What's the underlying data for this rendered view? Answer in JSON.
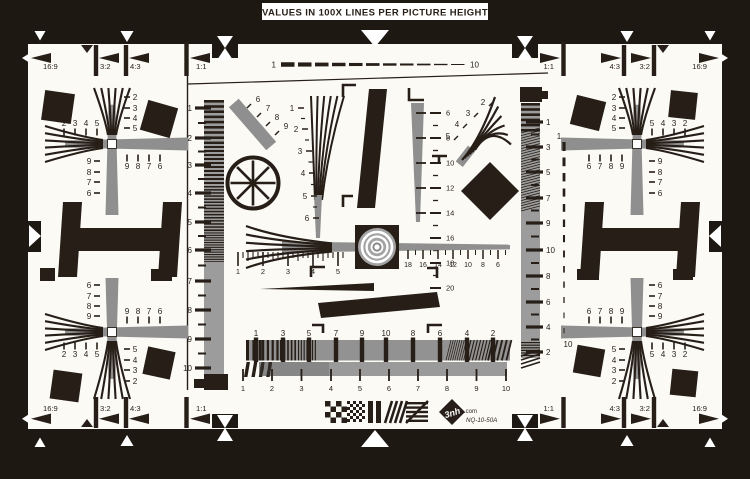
{
  "banner": {
    "text": "VALUES IN 100X LINES PER PICTURE HEIGHT"
  },
  "colors": {
    "background": "#1e1813",
    "surface": "#fbfaf5",
    "ink": "#261e17",
    "gray": "#8f8f8f",
    "gray_light": "#9c9c9c",
    "white": "#ffffff"
  },
  "aspect_markers": {
    "top_left": [
      "16:9",
      "3:2",
      "4:3",
      "1:1"
    ],
    "top_right": [
      "16:9",
      "3:2",
      "4:3",
      "1:1"
    ],
    "bottom_left": [
      "16:9",
      "3:2",
      "4:3",
      "1:1"
    ],
    "bottom_right": [
      "16:9",
      "3:2",
      "4:3",
      "1:1"
    ]
  },
  "scales": {
    "top_dash": [
      "1",
      "10"
    ],
    "right_dash": [
      "1",
      "10"
    ],
    "left_bar": [
      "1",
      "2",
      "3",
      "4",
      "5",
      "6",
      "7",
      "8",
      "9",
      "10"
    ],
    "right_bar": [
      "1",
      "3",
      "5",
      "7",
      "9",
      "10",
      "8",
      "6",
      "4",
      "2"
    ],
    "diagonal_bar": [
      "6",
      "7",
      "8",
      "9"
    ],
    "center_fan": [
      "1",
      "2",
      "3",
      "4",
      "5",
      "6"
    ],
    "center_right_wedge": [
      "6",
      "8",
      "10",
      "12",
      "14",
      "16",
      "18",
      "20"
    ],
    "top_right_fan": [
      "2",
      "3",
      "4",
      "5"
    ],
    "center_ruler_left": [
      "1",
      "2",
      "3",
      "4",
      "5"
    ],
    "center_ruler_right": [
      "18",
      "16",
      "14",
      "12",
      "10",
      "8",
      "6"
    ],
    "bottom_wedge_top": [
      "1",
      "3",
      "5",
      "7",
      "9",
      "10",
      "8",
      "6",
      "4",
      "2"
    ],
    "bottom_wedge_bottom": [
      "1",
      "2",
      "3",
      "4",
      "5",
      "6",
      "7",
      "8",
      "9",
      "10"
    ]
  },
  "clusters": {
    "top_left": {
      "vertical_top": [
        "2",
        "3",
        "4",
        "5"
      ],
      "horizontal_top": [
        "2",
        "3",
        "4",
        "5"
      ],
      "vertical_bottom": [
        "9",
        "8",
        "7",
        "6"
      ],
      "horizontal_bottom": [
        "9",
        "8",
        "7",
        "6"
      ]
    },
    "top_right": {
      "vertical_top": [
        "2",
        "3",
        "4",
        "5"
      ],
      "horizontal_top": [
        "5",
        "4",
        "3",
        "2"
      ],
      "vertical_bottom": [
        "9",
        "8",
        "7",
        "6"
      ],
      "horizontal_bottom": [
        "6",
        "7",
        "8",
        "9"
      ]
    },
    "bottom_left": {
      "vertical_top": [
        "6",
        "7",
        "8",
        "9"
      ],
      "horizontal_top": [
        "9",
        "8",
        "7",
        "6"
      ],
      "vertical_bottom": [
        "5",
        "4",
        "3",
        "2"
      ],
      "horizontal_bottom": [
        "2",
        "3",
        "4",
        "5"
      ]
    },
    "bottom_right": {
      "vertical_top": [
        "6",
        "7",
        "8",
        "9"
      ],
      "horizontal_top": [
        "6",
        "7",
        "8",
        "9"
      ],
      "vertical_bottom": [
        "5",
        "4",
        "3",
        "2"
      ],
      "horizontal_bottom": [
        "5",
        "4",
        "3",
        "2"
      ]
    }
  },
  "logo": {
    "brand": "3nh",
    "domain": ".com",
    "model": "NQ-10-50A"
  }
}
